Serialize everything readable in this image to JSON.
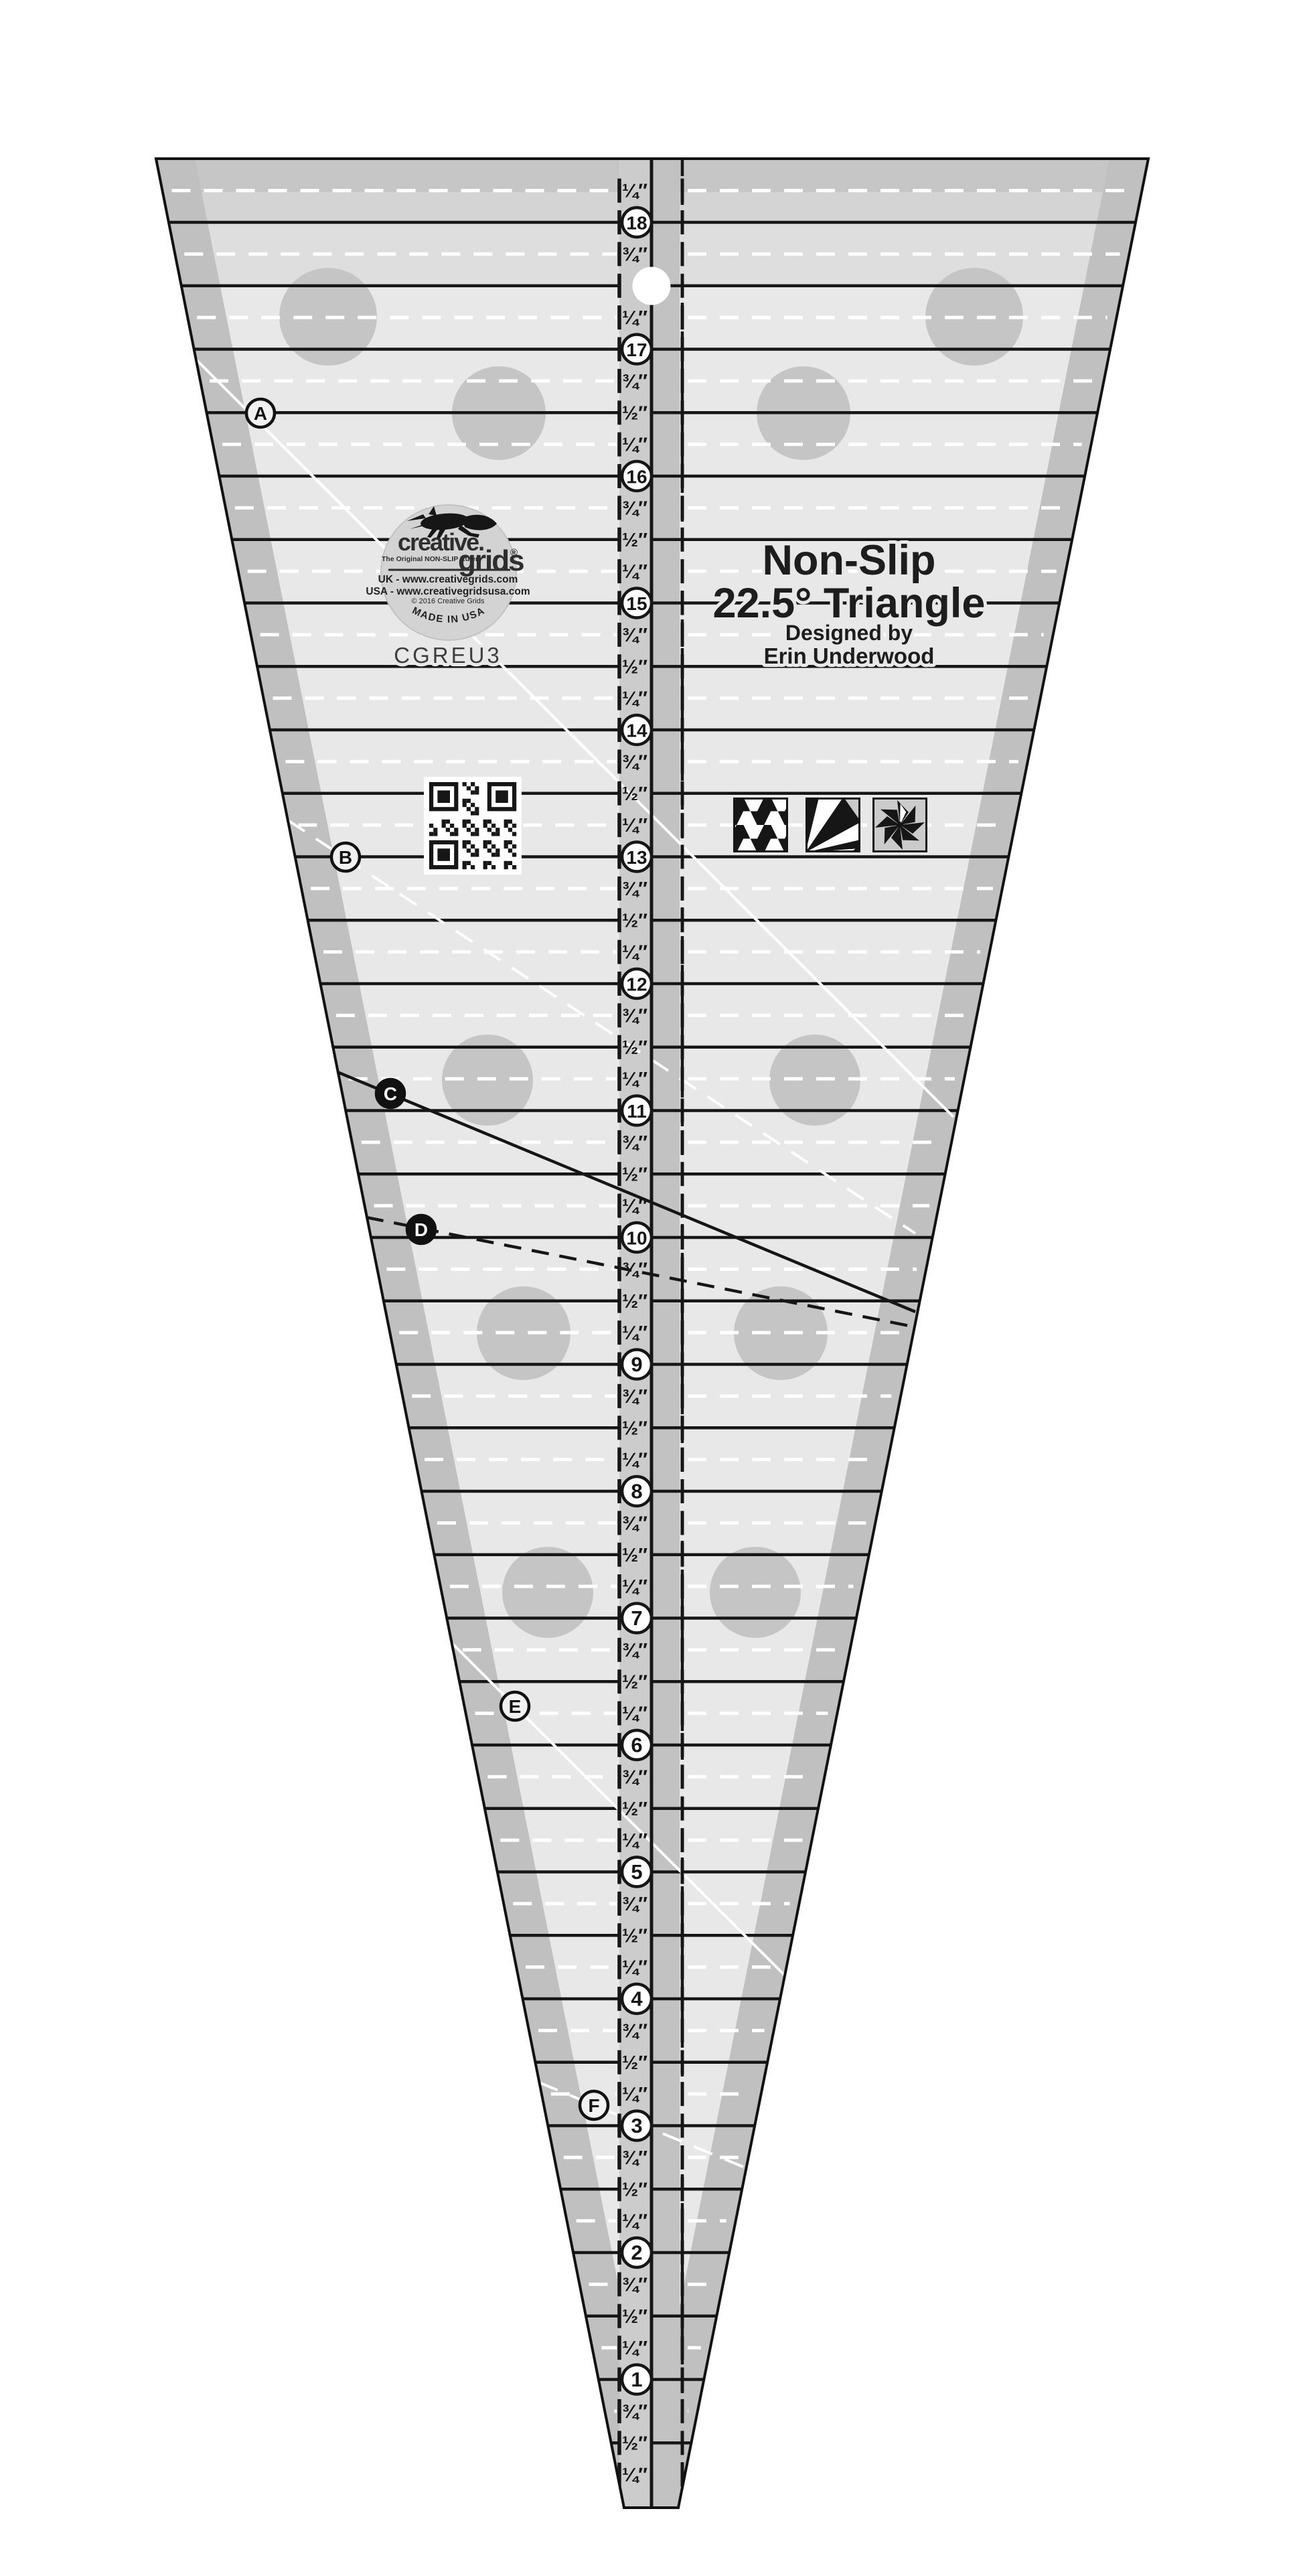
{
  "page": {
    "background": "#ffffff"
  },
  "ruler": {
    "product_title": {
      "line1": "Non-Slip",
      "line2": "22.5° Triangle",
      "byline": "Designed by",
      "designer": "Erin Underwood"
    },
    "model_number": "CGREU3",
    "logo": {
      "brand_line1": "creative.",
      "brand_line2": "grids",
      "registered_mark": "®",
      "tagline": "The Original NON-SLIP Ruler",
      "url_uk": "UK - www.creativegrids.com",
      "url_usa": "USA - www.creativegridsusa.com",
      "copyright": "© 2016 Creative Grids",
      "made_in": "MADE IN USA",
      "fox_icon": "leaping-fox"
    },
    "scale": {
      "unit": "inch",
      "whole_numbers": [
        1,
        2,
        3,
        4,
        5,
        6,
        7,
        8,
        9,
        10,
        11,
        12,
        13,
        14,
        15,
        16,
        17,
        18
      ],
      "fraction_labels": {
        "quarter": "¼″",
        "half": "½″",
        "three_quarter": "¾″"
      },
      "top_partial_label": "¼″"
    },
    "reference_letters": [
      {
        "label": "A",
        "marker": "outline-circle"
      },
      {
        "label": "B",
        "marker": "outline-circle"
      },
      {
        "label": "C",
        "marker": "filled-circle"
      },
      {
        "label": "D",
        "marker": "filled-circle"
      },
      {
        "label": "E",
        "marker": "outline-circle"
      },
      {
        "label": "F",
        "marker": "outline-circle"
      }
    ],
    "sample_blocks": [
      "tumbler-checkerboard-block",
      "fan-rays-block",
      "pinwheel-star-block"
    ],
    "qr_code": "qr-code",
    "hang_hole": "hang-hole",
    "colors": {
      "body": "#e8e8e8",
      "edge_band": "#c0c0c0",
      "top_band": "#c6c6c6",
      "top_band2": "#d4d4d4",
      "top_band3": "#dedede",
      "strip_left": "#cccccc",
      "strip_right": "#c2c2c2",
      "grip_dot": "#c5c5c5",
      "ink": "#161616",
      "white_guide": "#ffffff",
      "badge": "#d3d3d3"
    }
  }
}
